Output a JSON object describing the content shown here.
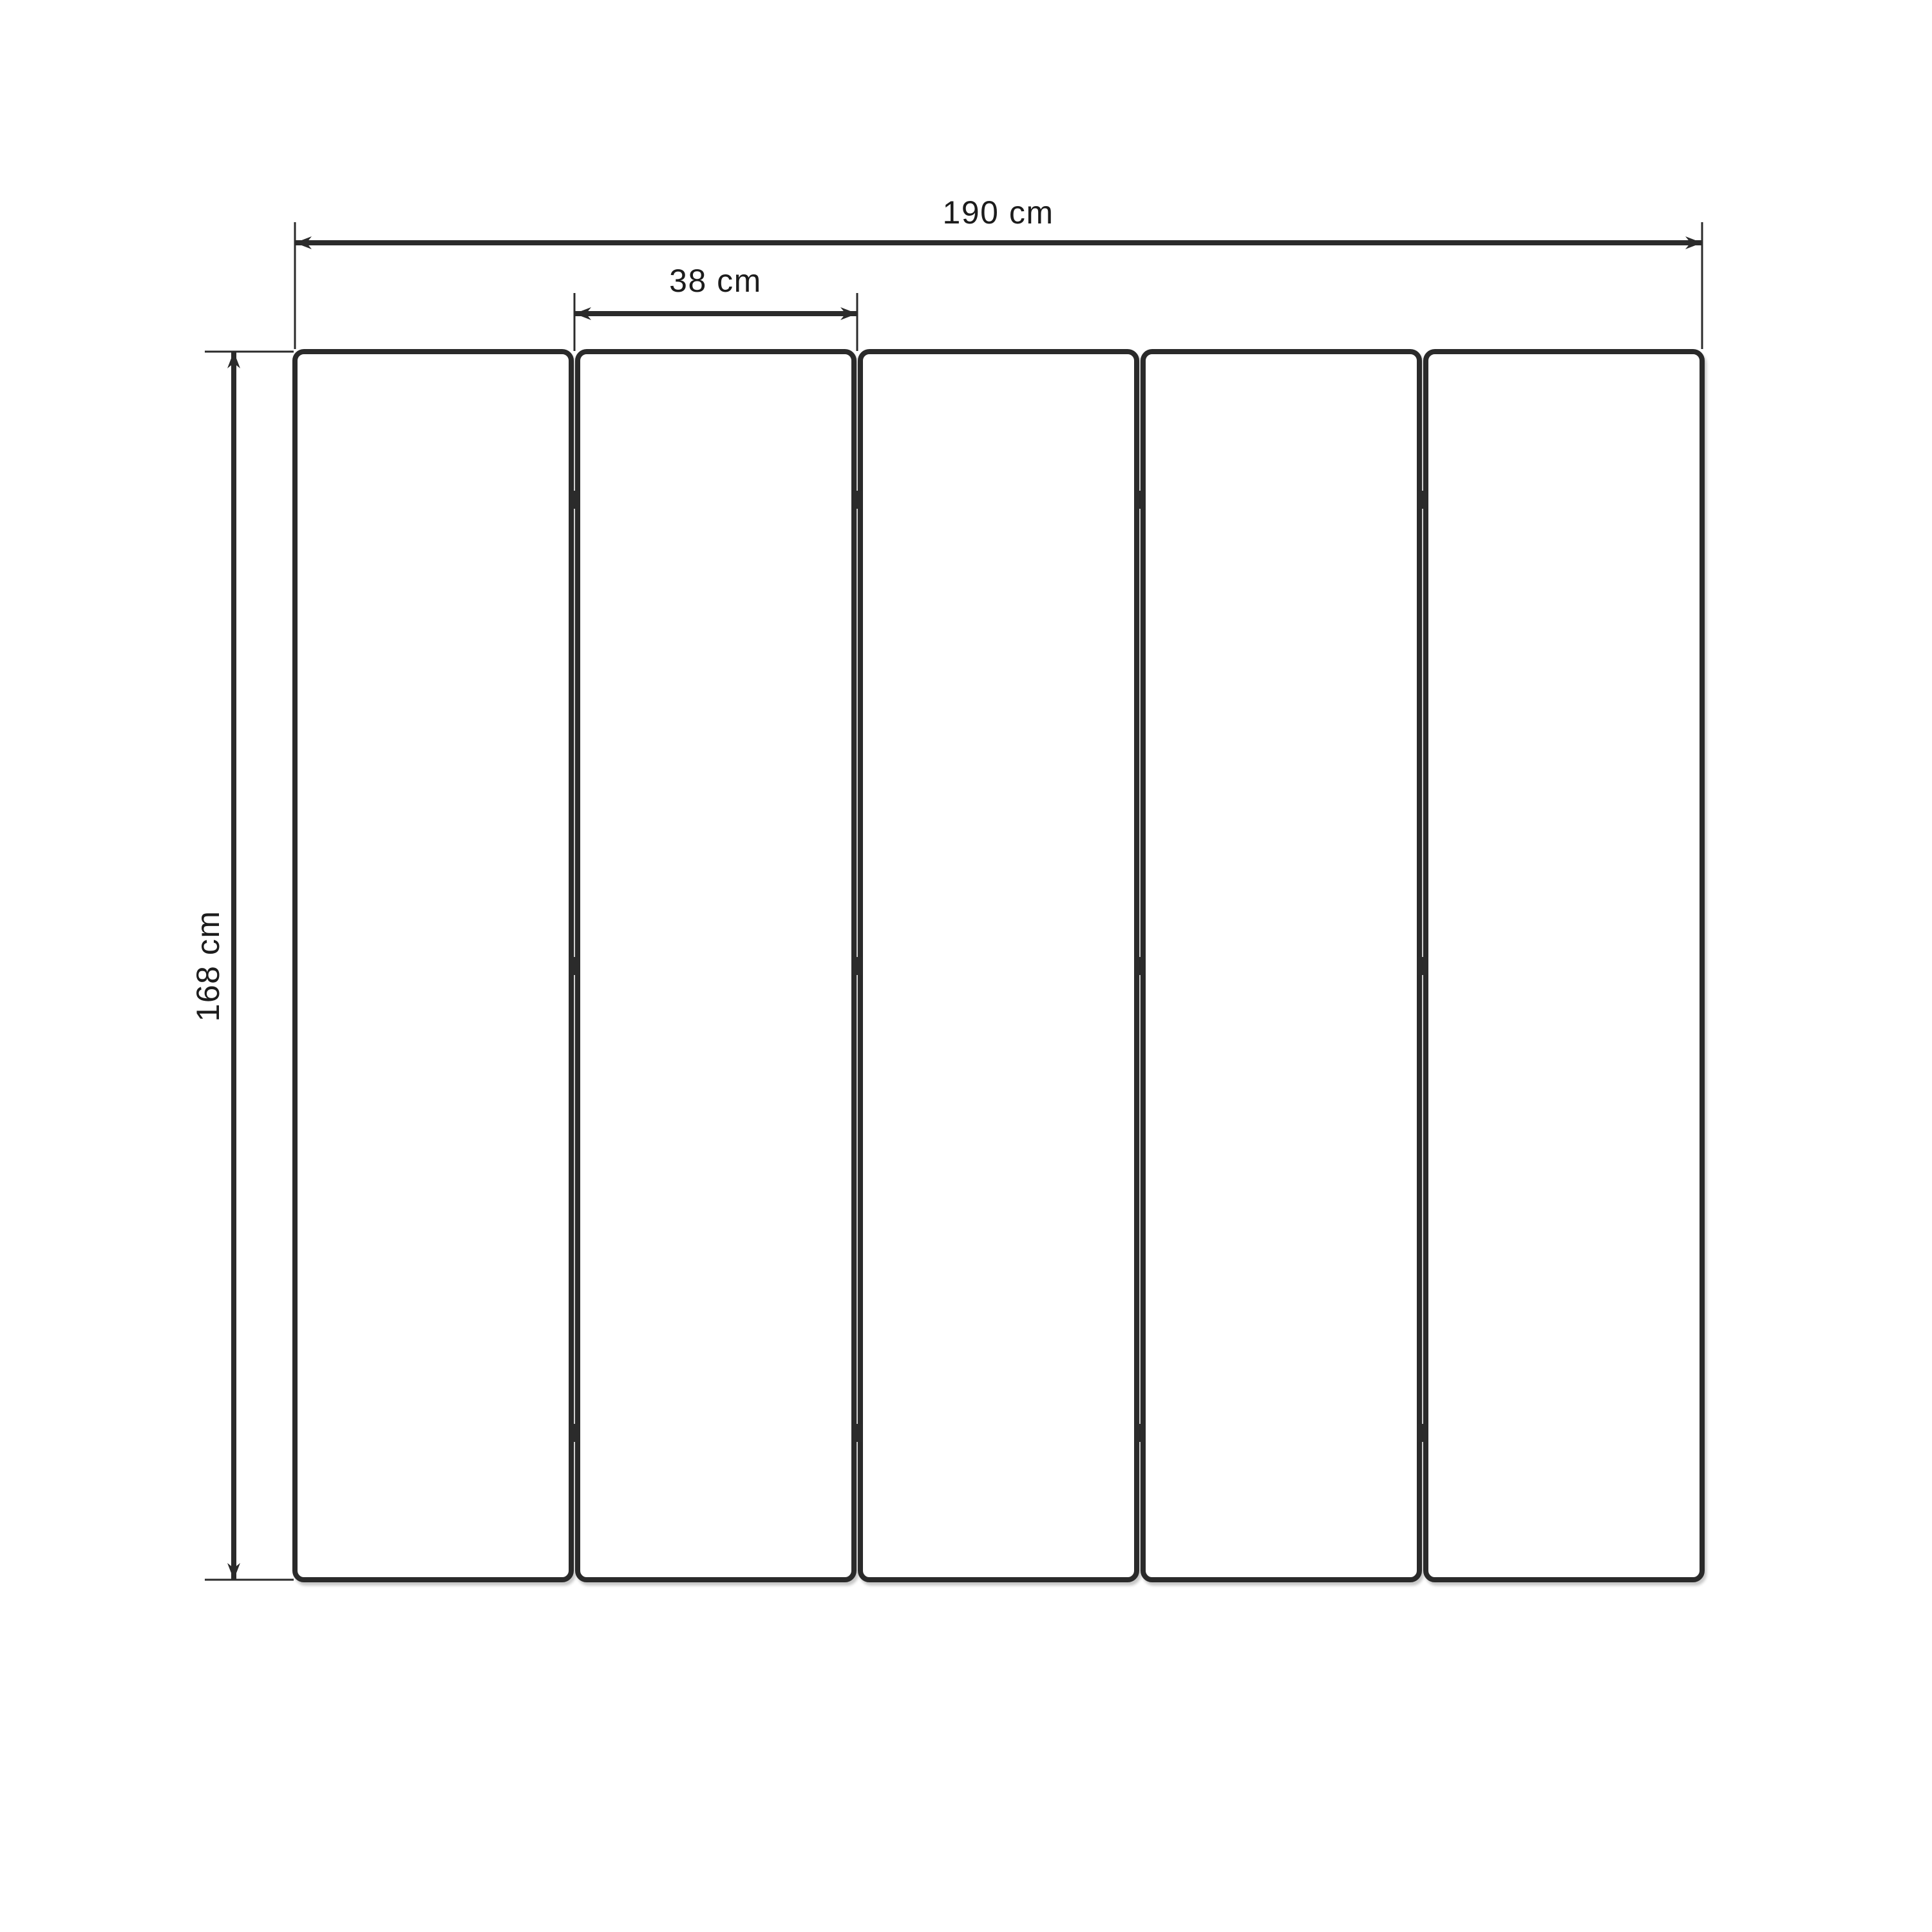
{
  "diagram": {
    "kind": "technical-dimension-drawing",
    "subject": "five-panel folding screen, front view",
    "background_color": "#ffffff",
    "line_color": "#2b2b2b",
    "text_color": "#1c1c1c",
    "panels": {
      "count": 5,
      "joints": 4,
      "hinges_per_joint": 3
    },
    "dimensions": {
      "total_width": {
        "label": "190 cm",
        "value": 190,
        "unit": "cm"
      },
      "panel_width": {
        "label": "38 cm",
        "value": 38,
        "unit": "cm"
      },
      "height": {
        "label": "168 cm",
        "value": 168,
        "unit": "cm"
      }
    }
  }
}
